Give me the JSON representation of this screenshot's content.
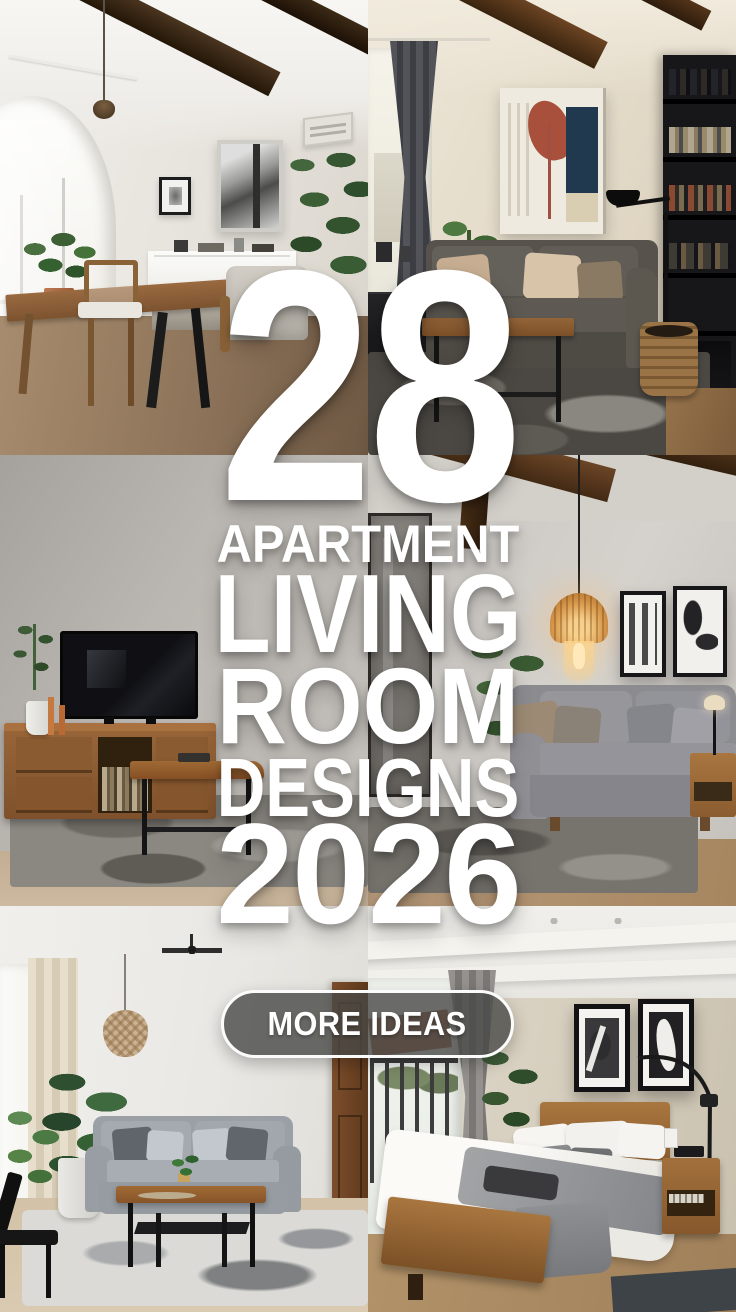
{
  "title": {
    "count": "28",
    "words": [
      "APARTMENT",
      "LIVING",
      "ROOM",
      "DESIGNS"
    ],
    "year": "2026"
  },
  "cta": {
    "label": "MORE IDEAS"
  },
  "colors": {
    "headline_text": "#ffffff",
    "cta_background": "rgba(71,73,70,0.8)",
    "cta_border": "#fbfbfb",
    "cta_text": "#ffffff"
  },
  "photos": [
    {
      "alt": "Dining room with arched window, wood dining table and dark ceiling beams"
    },
    {
      "alt": "Living room with dark grey sofa, abstract wall art and black bookshelf"
    },
    {
      "alt": "Living room with TV on wooden media console and grey rug"
    },
    {
      "alt": "Living room with amber glass pendant light over a grey sofa and framed art"
    },
    {
      "alt": "Living room with light grey sofa, plants and wood coffee table"
    },
    {
      "alt": "Bedroom with wood platform bed, framed artwork and balcony door"
    }
  ]
}
